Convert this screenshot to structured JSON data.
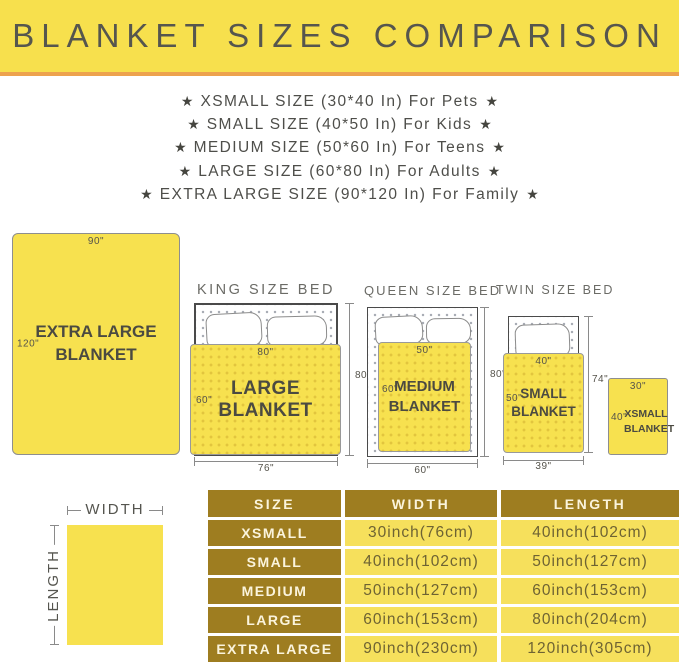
{
  "banner": {
    "title": "BLANKET SIZES COMPARISON"
  },
  "star": "★",
  "size_list": [
    {
      "text": "XSMALL SIZE (30*40 In) For Pets"
    },
    {
      "text": "SMALL SIZE (40*50 In) For Kids"
    },
    {
      "text": "MEDIUM SIZE (50*60 In) For Teens"
    },
    {
      "text": "LARGE SIZE (60*80 In) For Adults"
    },
    {
      "text": "EXTRA LARGE SIZE (90*120 In) For Family"
    }
  ],
  "diagrams": {
    "xl": {
      "label": "EXTRA LARGE BLANKET",
      "width_dim": "90\"",
      "length_dim": "120\""
    },
    "king": {
      "title": "KING SIZE BED",
      "blanket_label": "LARGE BLANKET",
      "blanket_width_dim": "80\"",
      "blanket_length_dim": "60\"",
      "bed_length_dim": "80\"",
      "bed_width_dim": "76\""
    },
    "queen": {
      "title": "QUEEN SIZE BED",
      "blanket_label": "MEDIUM BLANKET",
      "blanket_width_dim": "50\"",
      "blanket_length_dim": "60\"",
      "bed_length_dim": "80\"",
      "bed_width_dim": "60\""
    },
    "twin": {
      "title": "TWIN SIZE BED",
      "blanket_label": "SMALL BLANKET",
      "blanket_width_dim": "40\"",
      "blanket_length_dim": "50\"",
      "bed_length_dim": "74\"",
      "bed_width_dim": "39\""
    },
    "xsmall": {
      "label": "XSMALL BLANKET",
      "width_dim": "30\"",
      "length_dim": "40\""
    }
  },
  "legend": {
    "width_label": "WIDTH",
    "length_label": "LENGTH"
  },
  "table": {
    "headers": [
      "SIZE",
      "WIDTH",
      "LENGTH"
    ],
    "rows": [
      {
        "size": "XSMALL",
        "width": "30inch(76cm)",
        "length": "40inch(102cm)"
      },
      {
        "size": "SMALL",
        "width": "40inch(102cm)",
        "length": "50inch(127cm)"
      },
      {
        "size": "MEDIUM",
        "width": "50inch(127cm)",
        "length": "60inch(153cm)"
      },
      {
        "size": "LARGE",
        "width": "60inch(153cm)",
        "length": "80inch(204cm)"
      },
      {
        "size": "EXTRA LARGE",
        "width": "90inch(230cm)",
        "length": "120inch(305cm)"
      }
    ]
  },
  "colors": {
    "banner_bg": "#F7E04D",
    "banner_border": "#EDA24E",
    "blanket_yellow": "#F7E14F",
    "table_header_bg": "#9E7D20",
    "table_cell_bg": "#F6E05C",
    "table_text": "#6E6333",
    "text_dark": "#4B4A41"
  }
}
